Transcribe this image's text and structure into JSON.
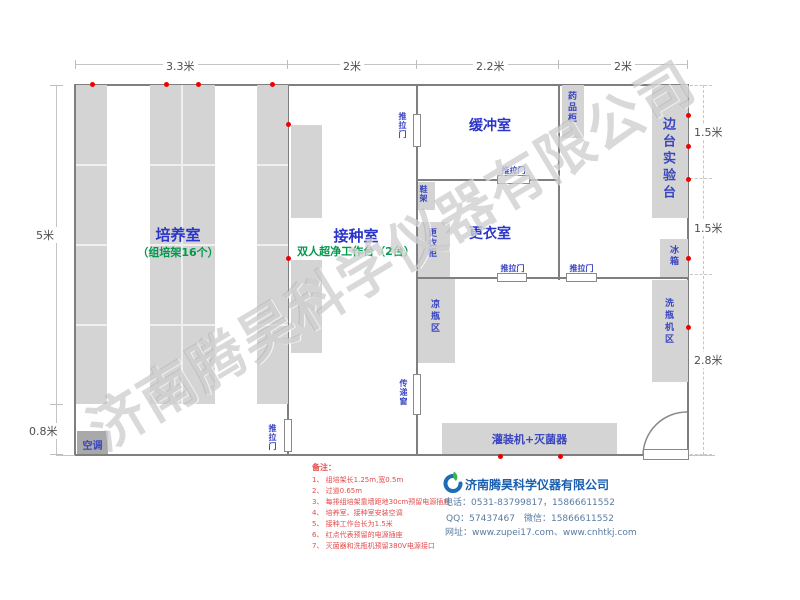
{
  "watermark": "济南腾昊科学仪器有限公司",
  "dims": {
    "top": [
      "3.3米",
      "2米",
      "2.2米",
      "2米"
    ],
    "left": [
      "5米",
      "0.8米"
    ],
    "right": [
      "1.5米",
      "1.5米",
      "2.8米"
    ]
  },
  "rooms": {
    "cultivation": "培养室",
    "cultivation_sub": "（组培架16个）",
    "inoculation": "接种室",
    "inoculation_sub": "双人超净工作台（2台）",
    "buffer": "缓冲室",
    "changing": "更衣室"
  },
  "fixtures": {
    "sliding_door": "推拉门",
    "transfer_window": "传递窗",
    "air_conditioner": "空调",
    "shoe_rack": "鞋架",
    "locker": "更衣柜",
    "cooling_bottle_area": "凉瓶区",
    "medicine_cabinet": "药品柜",
    "side_lab_bench": "边台实验台",
    "fridge": "冰箱",
    "bottle_washer_area": "洗瓶机区",
    "filler_sterilizer": "灌装机+灭菌器"
  },
  "notes": {
    "title": "备注：",
    "items": [
      "1、 组培架长1.25m,宽0.5m",
      "2、 过道0.65m",
      "3、 每排组培架靠墙距地30cm预留电源插座",
      "4、 培养室、接种室安装空调",
      "5、 接种工作台长为1.5米",
      "6、 红点代表预留的电源插座",
      "7、 灭菌器和洗瓶机预留380V电源接口"
    ]
  },
  "company": {
    "name": "济南腾昊科学仪器有限公司",
    "phone": "电话：0531-83799817，15866611552",
    "qq": "QQ：57437467　微信：15866611552",
    "web": "网址：www.zupei17.com、www.cnhtkj.com"
  },
  "colors": {
    "room_label_blue": "#2b35c8",
    "sub_label_green": "#00994d",
    "note_red": "#e24c4c",
    "dot_red": "#ee0000",
    "furniture_gray": "#d4d4d4",
    "wall_gray": "#7f7f7f",
    "company_blue": "#1b5fb0",
    "contact_blue": "#5a7ba2"
  }
}
